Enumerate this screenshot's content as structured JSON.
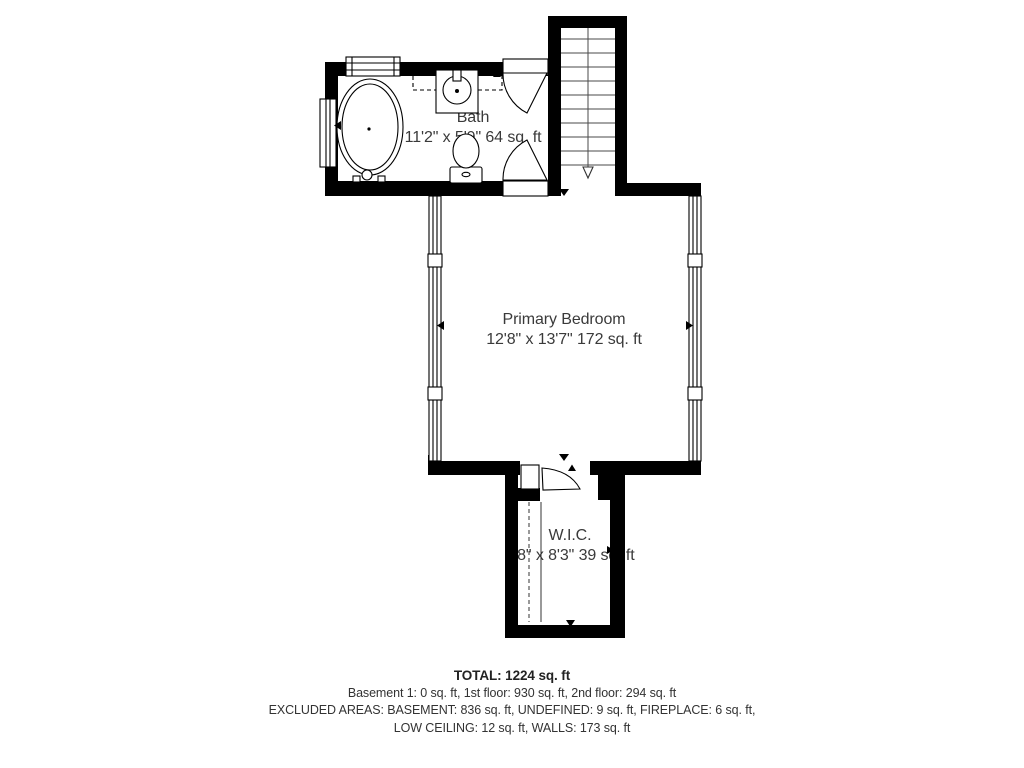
{
  "floor_plan": {
    "rooms": [
      {
        "id": "bath",
        "name": "Bath",
        "dims": "11'2\" x 5'9\" 64 sq. ft"
      },
      {
        "id": "primary_bedroom",
        "name": "Primary Bedroom",
        "dims": "12'8\" x 13'7\" 172 sq. ft"
      },
      {
        "id": "wic",
        "name": "W.I.C.",
        "dims": "4'8\" x 8'3\" 39 sq. ft"
      }
    ],
    "fixtures": [
      "bathtub",
      "sink-vanity",
      "toilet",
      "staircase",
      "closet-rod"
    ],
    "stairs": {
      "direction_arrow": "down",
      "tread_count": 11
    }
  },
  "summary": {
    "total": "TOTAL: 1224 sq. ft",
    "lines": [
      "Basement 1: 0 sq. ft, 1st floor: 930 sq. ft, 2nd floor: 294 sq. ft",
      "EXCLUDED AREAS: BASEMENT: 836 sq. ft, UNDEFINED: 9 sq. ft, FIREPLACE: 6 sq. ft,",
      "LOW CEILING: 12 sq. ft, WALLS: 173 sq. ft"
    ]
  },
  "colors": {
    "wall": "#000000",
    "room_text": "#3a3a3a",
    "summary_text": "#333333",
    "background": "#ffffff"
  }
}
